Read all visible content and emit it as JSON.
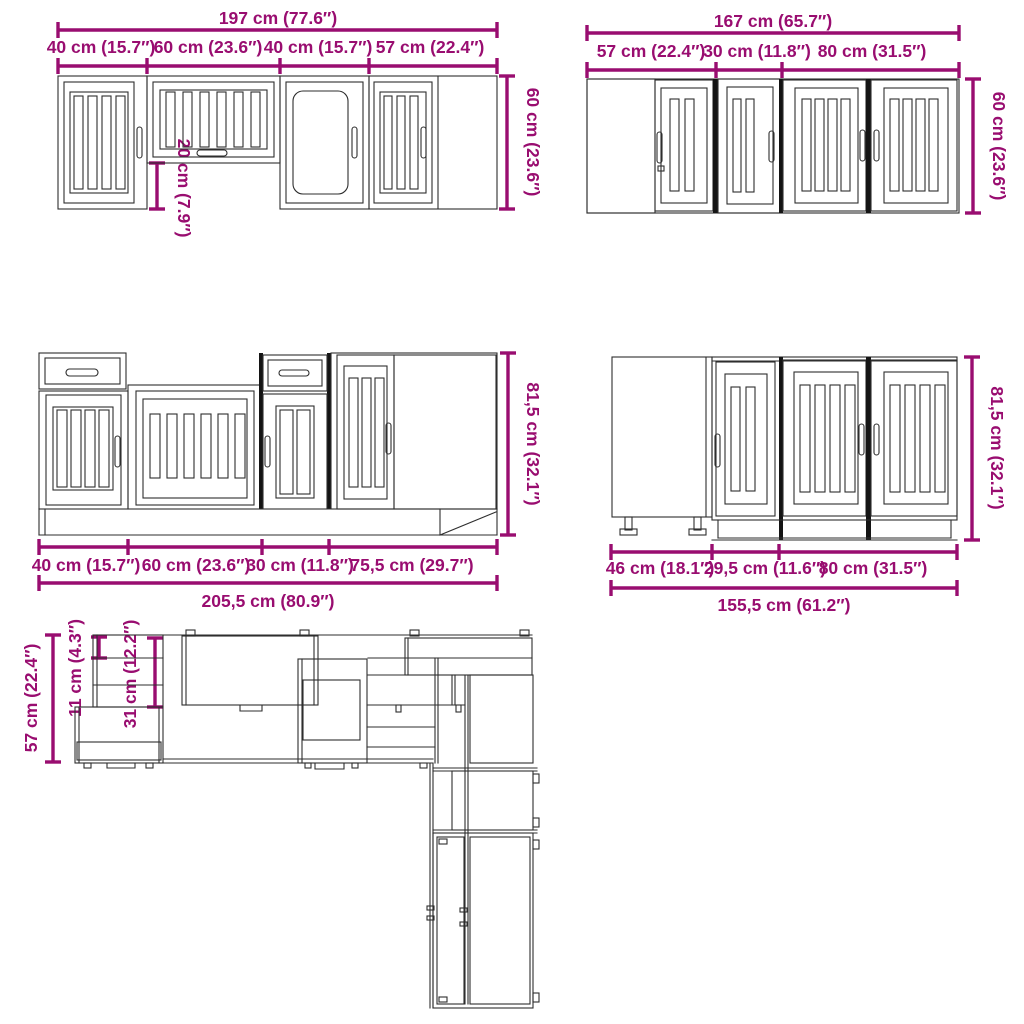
{
  "drawing_title": "kitchen-cabinet-set-dimension-diagram",
  "colors": {
    "dimension_magenta": "#990d70",
    "drawing_line": "#2e2e2e",
    "separator_black": "#141414",
    "background": "#ffffff"
  },
  "views": {
    "wall_left": {
      "total": "197 cm (77.6″)",
      "sections": [
        "40 cm (15.7″)",
        "60 cm (23.6″)",
        "40 cm (15.7″)",
        "57 cm (22.4″)"
      ],
      "height": "60 cm (23.6″)",
      "hood_gap": "20 cm (7.9″)"
    },
    "wall_right": {
      "total": "167 cm (65.7″)",
      "sections": [
        "57 cm (22.4″)",
        "30 cm (11.8″)",
        "80 cm (31.5″)"
      ],
      "height": "60 cm (23.6″)"
    },
    "base_left": {
      "total": "205,5 cm (80.9″)",
      "sections": [
        "40 cm (15.7″)",
        "60 cm (23.6″)",
        "30 cm (11.8″)",
        "75,5 cm (29.7″)"
      ],
      "height": "81,5 cm (32.1″)"
    },
    "base_right": {
      "total": "155,5 cm (61.2″)",
      "sections": [
        "46 cm (18.1″)",
        "29,5 cm (11.6″)",
        "80 cm (31.5″)"
      ],
      "height": "81,5 cm (32.1″)"
    },
    "plan": {
      "counter_depth": "57 cm (22.4″)",
      "back_gap": "11 cm (4.3″)",
      "wall_cabinet_depth": "31 cm (12.2″)"
    }
  }
}
